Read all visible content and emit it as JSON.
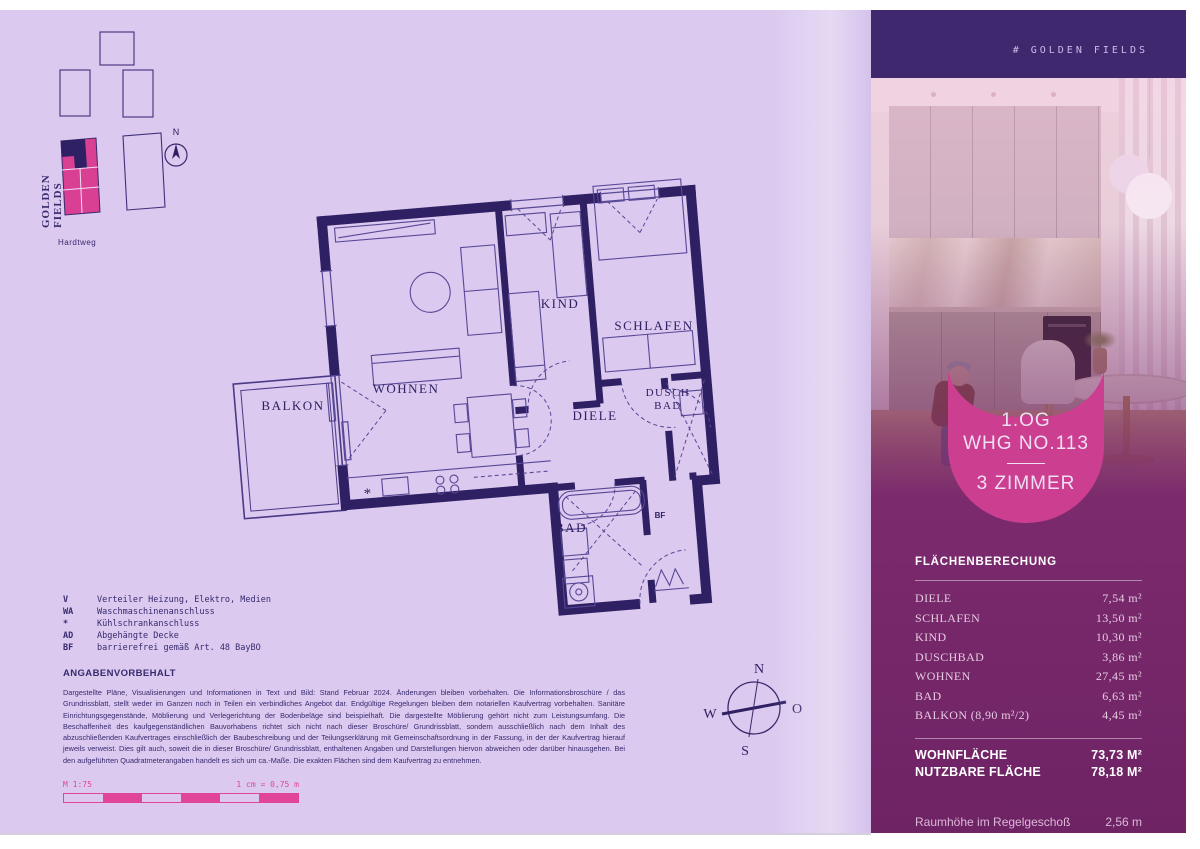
{
  "site_plan": {
    "project": "GOLDEN FIELDS",
    "street": "Hardtweg",
    "north": "N"
  },
  "plan_labels": {
    "balkon": "BALKON",
    "wohnen": "WOHNEN",
    "kind": "KIND",
    "schlafen": "SCHLAFEN",
    "diele": "DIELE",
    "dusch_line1": "DUSCH",
    "dusch_line2": "BAD",
    "bad": "BAD",
    "bf": "BF",
    "fridge": "*"
  },
  "legend": {
    "items": [
      {
        "key": "V",
        "label": "Verteiler Heizung, Elektro, Medien"
      },
      {
        "key": "WA",
        "label": "Waschmaschinenanschluss"
      },
      {
        "key": "*",
        "label": "Kühlschrankanschluss"
      },
      {
        "key": "AD",
        "label": "Abgehängte Decke"
      },
      {
        "key": "BF",
        "label": "barrierefrei gemäß Art. 48 BayBO"
      }
    ]
  },
  "disclaimer": {
    "title": "ANGABENVORBEHALT",
    "body": "Dargestellte Pläne, Visualisierungen und Informationen in Text und Bild: Stand Februar 2024. Änderungen bleiben vorbehalten. Die Informationsbroschüre / das Grundrissblatt, stellt weder im Ganzen noch in Teilen ein verbindliches Angebot dar. Endgültige Regelungen bleiben dem notariellen Kaufvertrag vorbehalten. Sanitäre Einrichtungsgegenstände, Möblierung und Verlegerichtung der Bodenbeläge sind beispielhaft. Die dargestellte Möblierung gehört nicht zum Leistungsumfang. Die Beschaffenheit des kaufgegenständlichen Bauvorhabens richtet sich nicht nach dieser Broschüre/ Grundrissblatt, sondern ausschließlich nach dem Inhalt des abzuschließenden Kaufvertrages einschließlich der Baubeschreibung und der Teilungserklärung mit Gemeinschaftsordnung in der Fassung, in der der Kaufvertrag hierauf jeweils verweist. Dies gilt auch, soweit die in dieser Broschüre/ Grundrissblatt, enthaltenen Angaben und Darstellungen hiervon abweichen oder darüber hinausgehen. Bei den aufgeführten Quadratmeterangaben handelt es sich um ca.-Maße. Die exakten Flächen sind dem Kaufvertrag zu entnehmen."
  },
  "scale": {
    "ratio": "M 1:75",
    "equivalence": "1 cm = 0,75 m"
  },
  "compass": {
    "n": "N",
    "w": "W",
    "o": "O",
    "s": "S"
  },
  "panel": {
    "brand": "# GOLDEN FIELDS",
    "badge": {
      "floor": "1.OG",
      "unit": "WHG NO.113",
      "rooms": "3 ZIMMER"
    },
    "area_table": {
      "title": "FLÄCHENBERECHUNG",
      "rows": [
        {
          "label": "DIELE",
          "value": "7,54 m²"
        },
        {
          "label": "SCHLAFEN",
          "value": "13,50 m²"
        },
        {
          "label": "KIND",
          "value": "10,30 m²"
        },
        {
          "label": "DUSCHBAD",
          "value": "3,86 m²"
        },
        {
          "label": "WOHNEN",
          "value": "27,45 m²"
        },
        {
          "label": "BAD",
          "value": "6,63 m²"
        },
        {
          "label": "BALKON (8,90 m²/2)",
          "value": "4,45 m²"
        }
      ],
      "totals": [
        {
          "label": "WOHNFLÄCHE",
          "value": "73,73 M²"
        },
        {
          "label": "NUTZBARE FLÄCHE",
          "value": "78,18 M²"
        }
      ],
      "ceiling_height": {
        "label": "Raumhöhe im Regelgeschoß",
        "value": "2,56 m"
      }
    }
  },
  "colors": {
    "page_lavender": "#dbc9ef",
    "plan_dark": "#2e2063",
    "accent_pink": "#d94094",
    "header_purple": "#40286e",
    "panel_purple": "#7b2a6d"
  }
}
